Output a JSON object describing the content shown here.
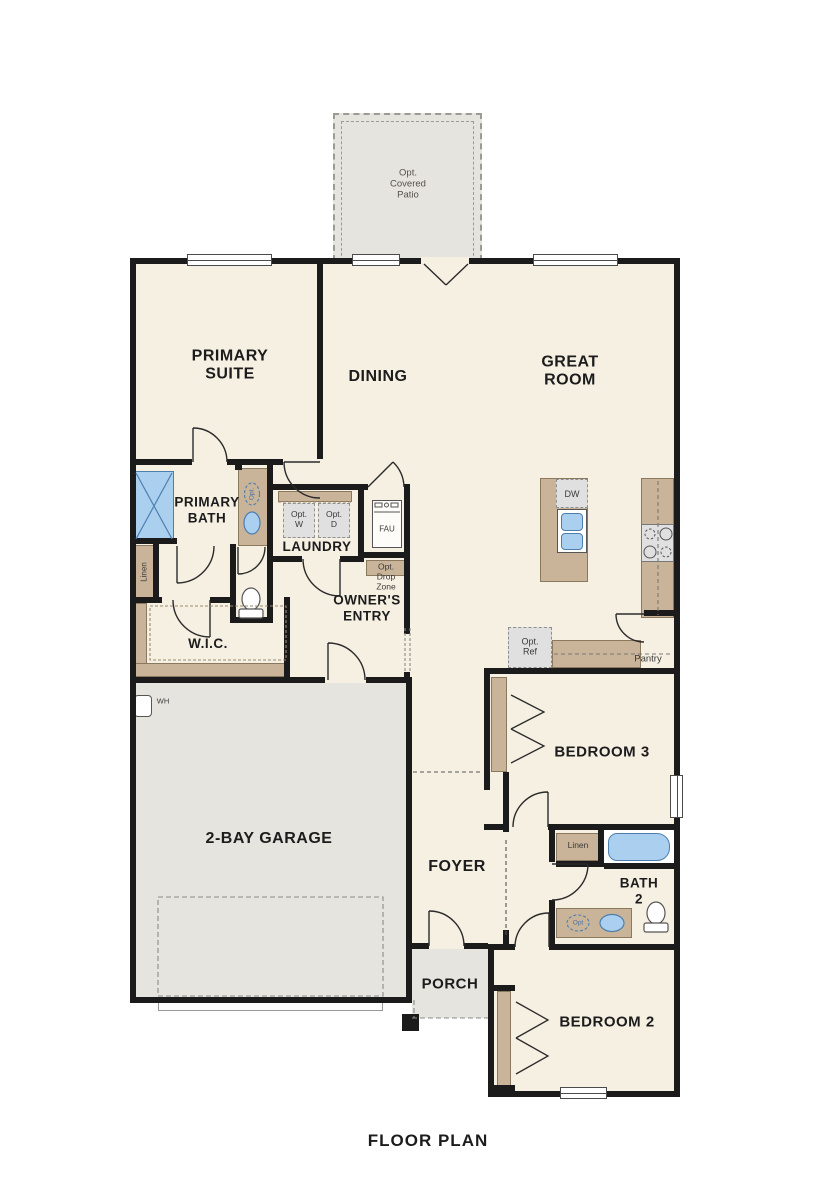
{
  "title": {
    "text": "FLOOR PLAN"
  },
  "colors": {
    "wall": "#1b1b1b",
    "floor": "#f6f0e3",
    "concrete": "#e6e4df",
    "cabinet": "#c9b49a",
    "cabinet_border": "#8a795f",
    "fixture_blue": "#abd0ef",
    "fixture_blue_border": "#4d7fae",
    "appliance_gray": "#e0e0e0",
    "dash_gray": "#9a9a9a",
    "text": "#1c1c1c"
  },
  "rooms": {
    "opt_covered_patio": {
      "label": "Opt.\nCovered\nPatio"
    },
    "primary_suite": {
      "label": "PRIMARY\nSUITE"
    },
    "dining": {
      "label": "DINING"
    },
    "great_room": {
      "label": "GREAT\nROOM"
    },
    "primary_bath": {
      "label": "PRIMARY\nBATH"
    },
    "laundry": {
      "label": "LAUNDRY"
    },
    "owners_entry": {
      "label": "OWNER'S\nENTRY"
    },
    "wic": {
      "label": "W.I.C."
    },
    "two_bay_garage": {
      "label": "2-BAY GARAGE"
    },
    "foyer": {
      "label": "FOYER"
    },
    "bedroom_3": {
      "label": "BEDROOM 3"
    },
    "pantry": {
      "label": "Pantry"
    },
    "bath_2": {
      "label": "BATH\n2"
    },
    "bedroom_2": {
      "label": "BEDROOM 2"
    },
    "porch": {
      "label": "PORCH"
    }
  },
  "fixtures": {
    "opt_washer": {
      "label": "Opt.\nW"
    },
    "opt_dryer": {
      "label": "Opt.\nD"
    },
    "fau": {
      "label": "FAU"
    },
    "opt_drop_zone": {
      "label": "Opt.\nDrop\nZone"
    },
    "dishwasher": {
      "label": "DW"
    },
    "opt_refrigerator": {
      "label": "Opt.\nRef"
    },
    "water_heater": {
      "label": "WH"
    },
    "linen_primary": {
      "label": "Linen"
    },
    "linen_bath_2": {
      "label": "Linen"
    },
    "opt_sink_primary": {
      "label": "Opt."
    },
    "opt_sink_bath_2": {
      "label": "Opt"
    }
  }
}
